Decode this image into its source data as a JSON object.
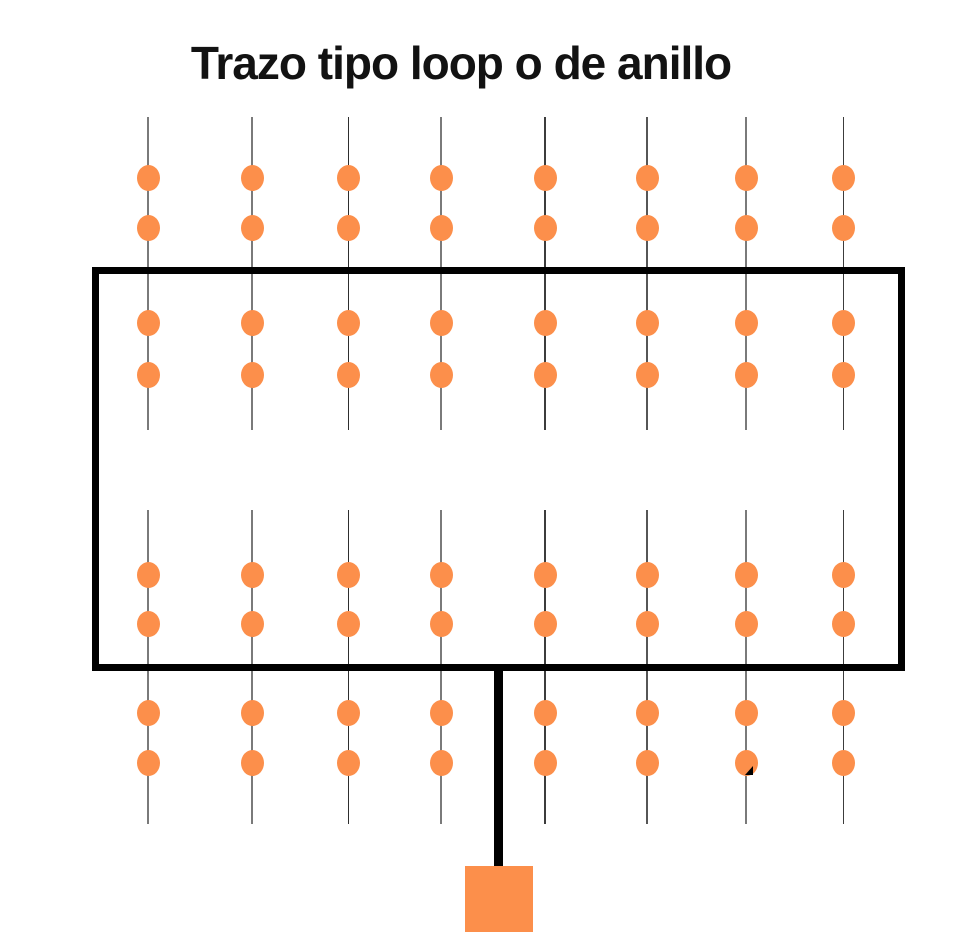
{
  "title": "Trazo tipo loop o de anillo",
  "colors": {
    "background": "#ffffff",
    "emitter_orange": "#FC8F4B",
    "pipe_black": "#000000",
    "title_text": "#121212"
  },
  "diagram": {
    "lateral_count": 8,
    "emitters_per_lateral": 8,
    "laterals": {
      "x_positions": [
        148,
        252,
        348,
        441,
        545,
        647,
        746,
        843
      ],
      "line_styles": [
        {
          "color": "#7a7a7a",
          "width": 2
        },
        {
          "color": "#7a7a7a",
          "width": 2
        },
        {
          "color": "#2e2e2e",
          "width": 1
        },
        {
          "color": "#7a7a7a",
          "width": 2
        },
        {
          "color": "#3c3c3c",
          "width": 2
        },
        {
          "color": "#565656",
          "width": 2
        },
        {
          "color": "#7a7a7a",
          "width": 2
        },
        {
          "color": "#3c3c3c",
          "width": 1
        }
      ],
      "top_segment": {
        "y1": 117,
        "y2": 430
      },
      "bottom_segment": {
        "y1": 510,
        "y2": 824
      }
    },
    "emitter_rows_y": [
      178,
      228,
      323,
      375,
      575,
      624,
      713,
      763
    ],
    "emitter_size": {
      "w": 23,
      "h": 26
    },
    "loop_rect": {
      "left": 92,
      "top": 267,
      "width": 813,
      "height": 404,
      "stroke_width": 7
    },
    "supply_pipe": {
      "left": 494,
      "top": 664,
      "width": 9,
      "height": 203
    },
    "source_square": {
      "left": 465,
      "top": 866,
      "width": 68,
      "height": 66
    },
    "ink_mark": {
      "left": 745,
      "top": 766,
      "width": 8,
      "height": 9
    }
  }
}
